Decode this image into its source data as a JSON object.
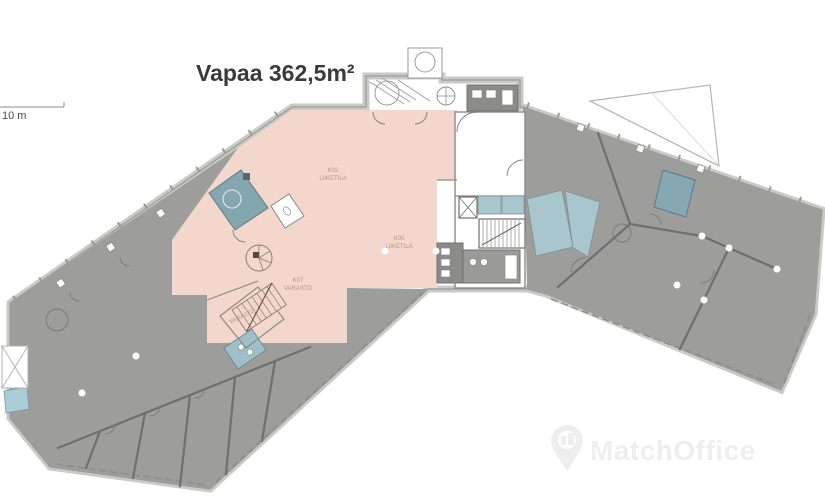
{
  "title": {
    "text": "Vapaa 362,5m²"
  },
  "scale_bar": {
    "label": "10 m"
  },
  "floor_plan": {
    "rooms": [
      {
        "id": "K02",
        "type": "LIIKETILA"
      },
      {
        "id": "K05",
        "type": "LIIKETILA"
      },
      {
        "id": "K07",
        "type": "VARASTO"
      },
      {
        "type": "VARASTO"
      }
    ],
    "colors": {
      "available_area": "#f3d7cc",
      "leased_area": "#9d9d9b",
      "dark_rooms": "#8b8b89",
      "wet_room_teal": "#84a6af",
      "light_teal": "#a9c6cd",
      "walls": "#6f6f6d"
    }
  },
  "watermark": {
    "text": "MatchOffice",
    "icon": "map-pin-building-icon",
    "color": "#eeeeee"
  }
}
